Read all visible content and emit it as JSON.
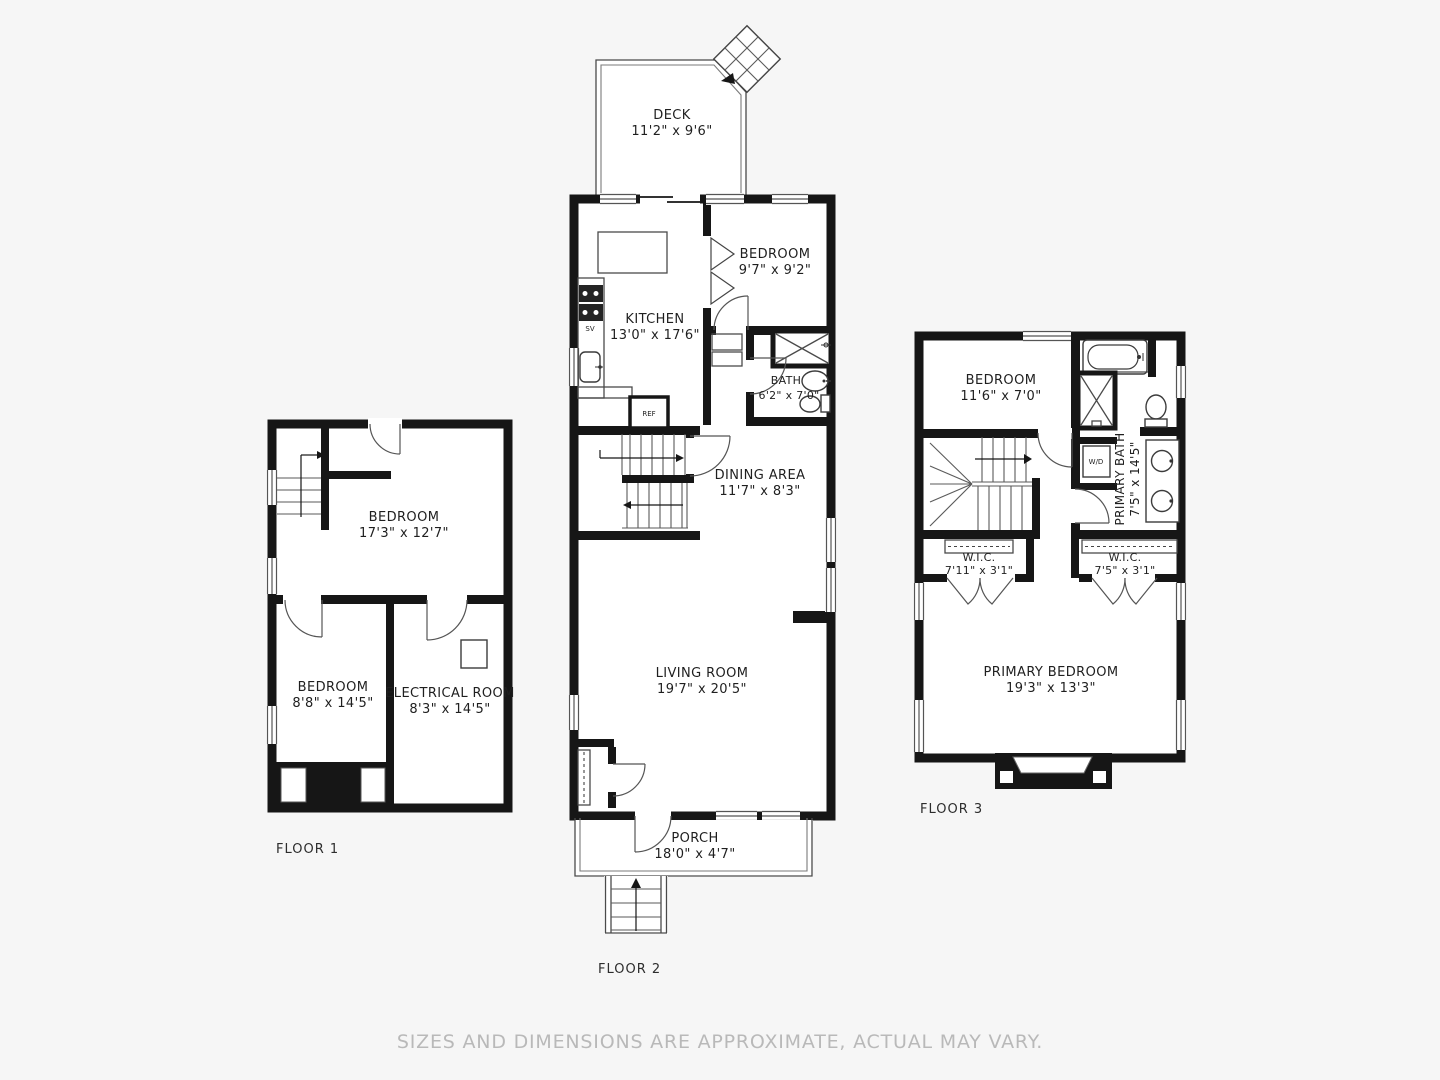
{
  "page": {
    "background": "#f6f6f6",
    "wall_color": "#161616",
    "line_color": "#4a4a4a",
    "text_color": "#1f1f1f",
    "muted_text_color": "#b9b9b9",
    "disclaimer": "SIZES AND DIMENSIONS ARE APPROXIMATE, ACTUAL MAY VARY."
  },
  "floor1": {
    "label": "FLOOR 1",
    "bedroom_large": {
      "name": "BEDROOM",
      "dims": "17'3\" x 12'7\""
    },
    "bedroom_small": {
      "name": "BEDROOM",
      "dims": "8'8\" x 14'5\""
    },
    "electrical_room": {
      "name": "ELECTRICAL ROOM",
      "dims": "8'3\" x 14'5\""
    }
  },
  "floor2": {
    "label": "FLOOR 2",
    "deck": {
      "name": "DECK",
      "dims": "11'2\" x 9'6\""
    },
    "bedroom": {
      "name": "BEDROOM",
      "dims": "9'7\" x 9'2\""
    },
    "kitchen": {
      "name": "KITCHEN",
      "dims": "13'0\" x 17'6\""
    },
    "bath": {
      "name": "BATH",
      "dims": "6'2\" x 7'0\""
    },
    "dining_area": {
      "name": "DINING AREA",
      "dims": "11'7\" x 8'3\""
    },
    "living_room": {
      "name": "LIVING ROOM",
      "dims": "19'7\" x 20'5\""
    },
    "porch": {
      "name": "PORCH",
      "dims": "18'0\" x 4'7\""
    },
    "labels": {
      "ref": "REF",
      "sv": "SV"
    }
  },
  "floor3": {
    "label": "FLOOR 3",
    "bedroom": {
      "name": "BEDROOM",
      "dims": "11'6\" x 7'0\""
    },
    "primary_bath": {
      "name": "PRIMARY BATH",
      "dims": "7'5\" x 14'5\""
    },
    "wic_left": {
      "name": "W.I.C.",
      "dims": "7'11\" x 3'1\""
    },
    "wic_right": {
      "name": "W.I.C.",
      "dims": "7'5\" x 3'1\""
    },
    "primary_bedroom": {
      "name": "PRIMARY BEDROOM",
      "dims": "19'3\" x 13'3\""
    },
    "labels": {
      "wd": "W/D"
    }
  }
}
